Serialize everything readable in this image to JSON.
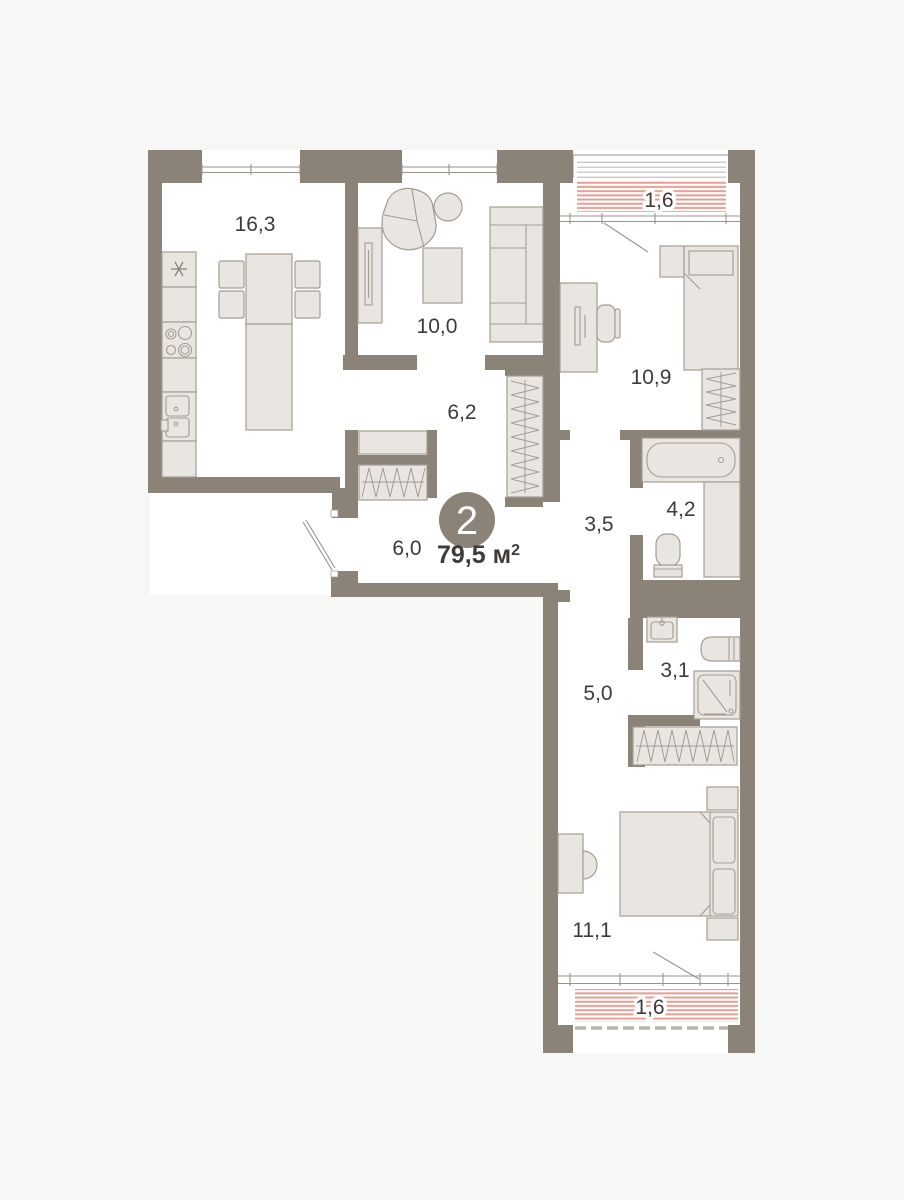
{
  "unit": {
    "rooms_badge": "2",
    "area_value": "79,5",
    "area_unit": "м",
    "area_sup": "2"
  },
  "rooms": {
    "kitchen": "16,3",
    "living": "10,0",
    "hall_upper": "6,2",
    "balcony_top": "1,6",
    "bedroom_small": "10,9",
    "hall_inner": "3,5",
    "bathroom": "4,2",
    "hall_entry": "6,0",
    "laundry": "3,1",
    "corridor": "5,0",
    "bedroom_large": "11,1",
    "balcony_bottom": "1,6"
  },
  "colors": {
    "bg": "#f7f7f5",
    "floor": "#ffffff",
    "wall": "#8b8278",
    "furn": "#e9e6e1",
    "furnstroke": "#a49c93",
    "line": "#9a938a",
    "stripe_red": "#e79a8e",
    "stripe_gray": "#c9c5c0",
    "stripe_dash": "#b8b3ad",
    "text": "#3e3b38",
    "badge": "#8b8278",
    "badge_text": "#ffffff"
  }
}
